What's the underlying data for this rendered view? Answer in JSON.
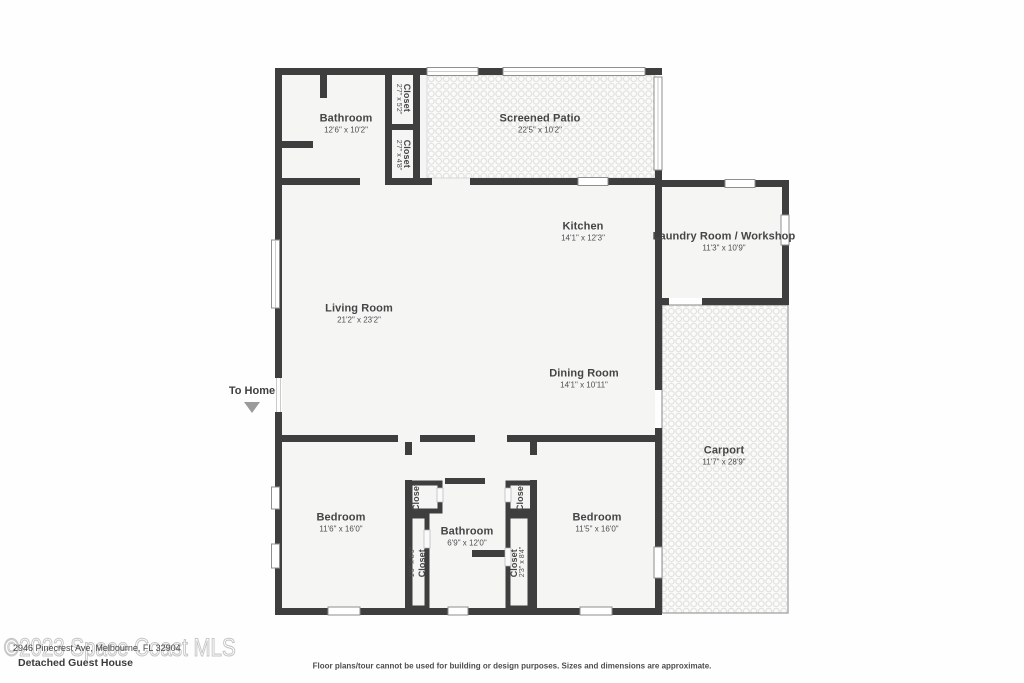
{
  "title": "Detached Guest House",
  "watermark": "©2023 Space Coast MLS",
  "address": "2946 Pinecrest Ave, Melbourne, FL 32904",
  "disclaimer": "Floor plans/tour cannot be used for building or design purposes. Sizes and dimensions are approximate.",
  "to_home": "To Home",
  "colors": {
    "wall": "#3e3e3e",
    "floor": "#f5f5f4",
    "pattern_dot": "#e3e3e2",
    "arrow": "#9b9b9b",
    "watermark_outline": "#c6c6c6"
  },
  "rooms": {
    "bathroom_top": {
      "name": "Bathroom",
      "dims": "12'6\" x 10'2\""
    },
    "closet_top_1": {
      "name": "Closet",
      "dims": "2'7\" x 5'2\""
    },
    "closet_top_2": {
      "name": "Closet",
      "dims": "2'7\" x 4'8\""
    },
    "screened_patio": {
      "name": "Screened Patio",
      "dims": "22'5\" x 10'2\""
    },
    "kitchen": {
      "name": "Kitchen",
      "dims": "14'1\" x 12'3\""
    },
    "laundry": {
      "name": "Laundry Room / Workshop",
      "dims": "11'3\" x 10'9\""
    },
    "living_room": {
      "name": "Living Room",
      "dims": "21'2\" x 23'2\""
    },
    "dining_room": {
      "name": "Dining Room",
      "dims": "14'1\" x 10'11\""
    },
    "carport": {
      "name": "Carport",
      "dims": "11'7\" x 28'9\""
    },
    "bedroom_left": {
      "name": "Bedroom",
      "dims": "11'6\" x 16'0\""
    },
    "bedroom_right": {
      "name": "Bedroom",
      "dims": "11'5\" x 16'0\""
    },
    "bathroom_bottom": {
      "name": "Bathroom",
      "dims": "6'9\" x 12'0\""
    },
    "closet_hall_left": {
      "name": "Closet"
    },
    "closet_hall_right": {
      "name": "Closet"
    },
    "closet_bottom_left": {
      "name": "Closet",
      "dims": "1'9\" x 8'9\""
    },
    "closet_bottom_right": {
      "name": "Closet",
      "dims": "2'3\" x 8'4\""
    }
  }
}
